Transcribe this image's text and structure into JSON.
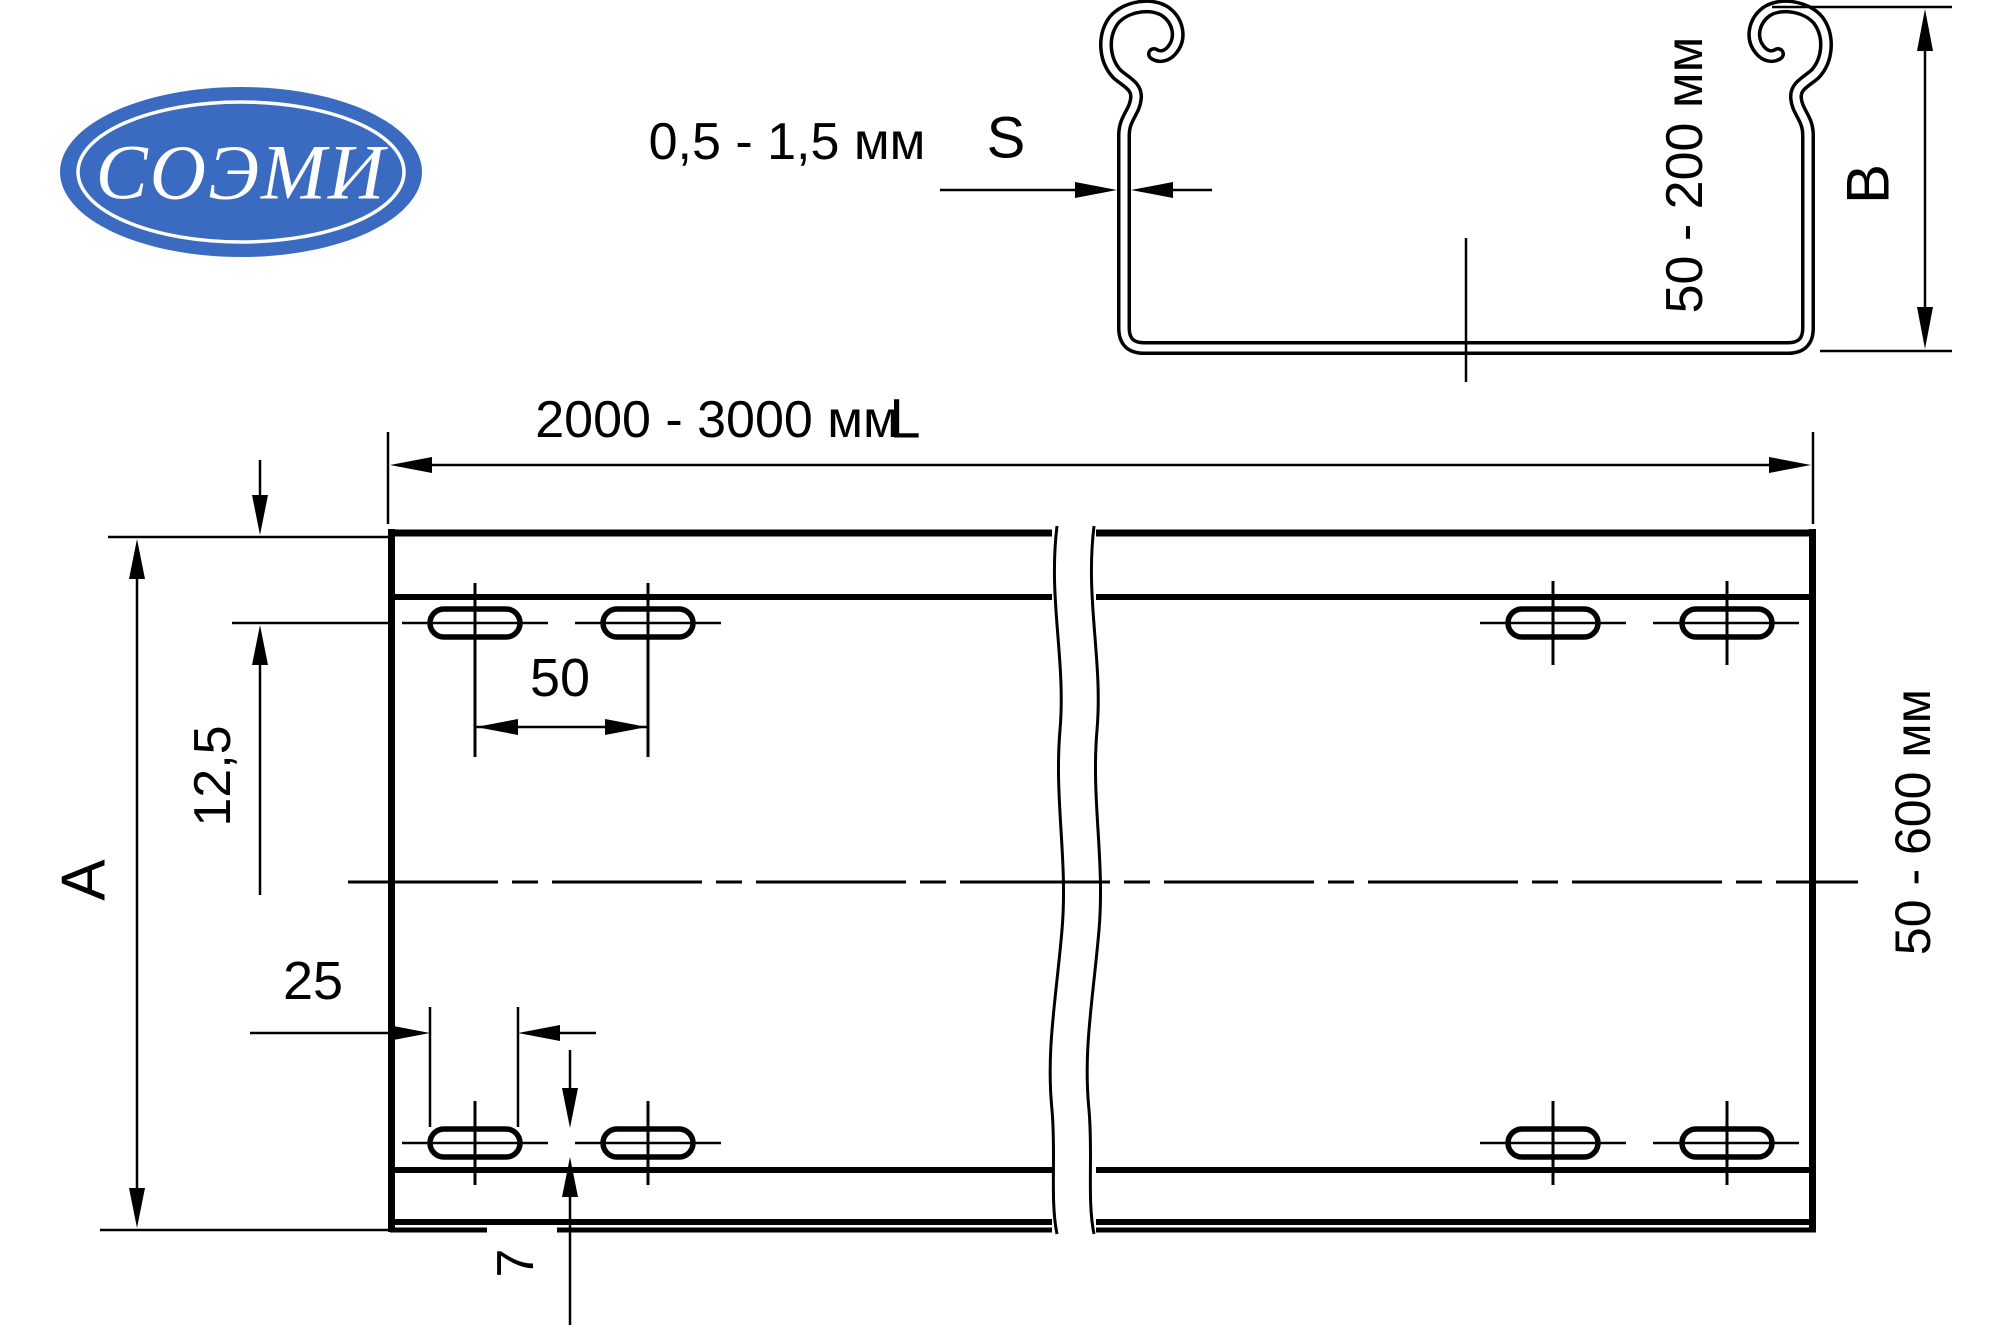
{
  "logo": {
    "text": "СОЭМИ",
    "color": "#3a6bc0"
  },
  "colors": {
    "line": "#000000",
    "background": "#ffffff"
  },
  "cross_section": {
    "thickness_value": "0,5 - 1,5 мм",
    "thickness_symbol": "S",
    "height_value": "50 - 200 мм",
    "height_symbol": "B"
  },
  "plan_view": {
    "length_value": "2000 - 3000 мм",
    "length_symbol": "L",
    "width_value": "50 - 600 мм",
    "width_symbol": "A",
    "slot_pitch": "50",
    "slot_length": "25",
    "edge_offset": "12,5",
    "slot_width": "7"
  }
}
